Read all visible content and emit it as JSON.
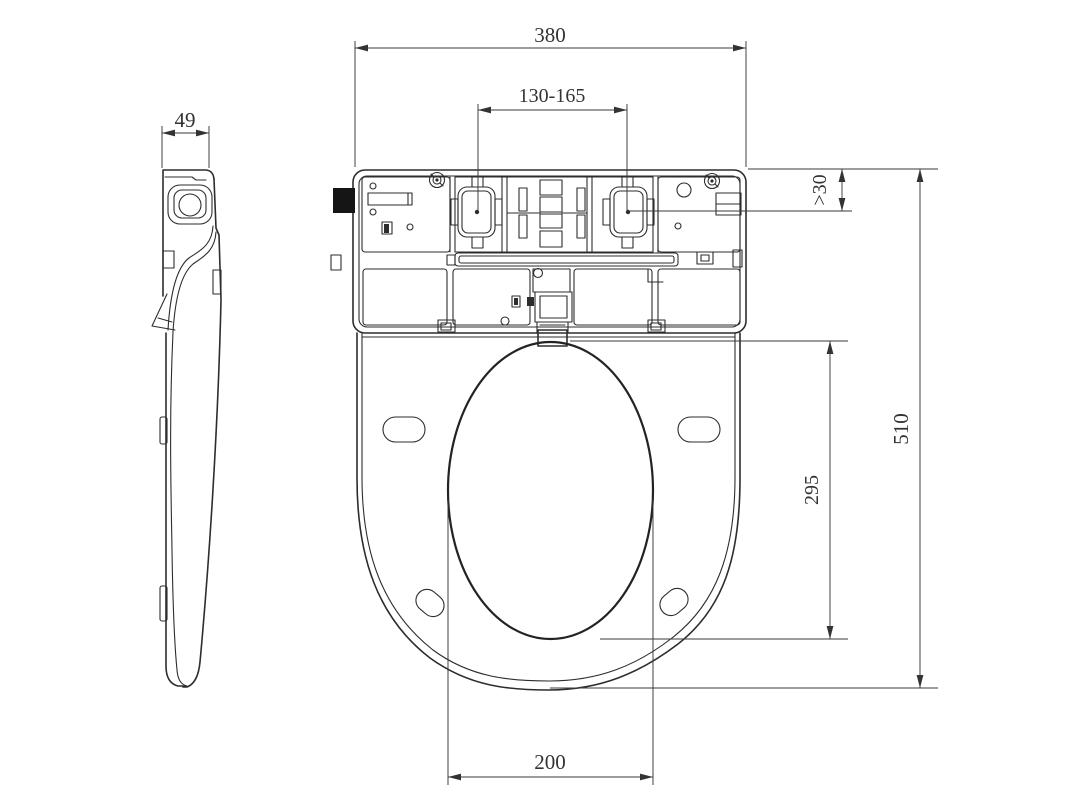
{
  "drawing": {
    "title": "toilet-seat-orthographic-views",
    "background_color": "#ffffff",
    "line_color": "#2d2d2d",
    "dimension_color": "#3a3a3a",
    "dimensions": {
      "overall_width": "380",
      "mount_hole_spacing": "130-165",
      "side_profile_width": "49",
      "tank_clearance": ">30",
      "overall_length": "510",
      "hinge_to_bowl_front": "295",
      "bowl_opening_width": "200"
    }
  }
}
